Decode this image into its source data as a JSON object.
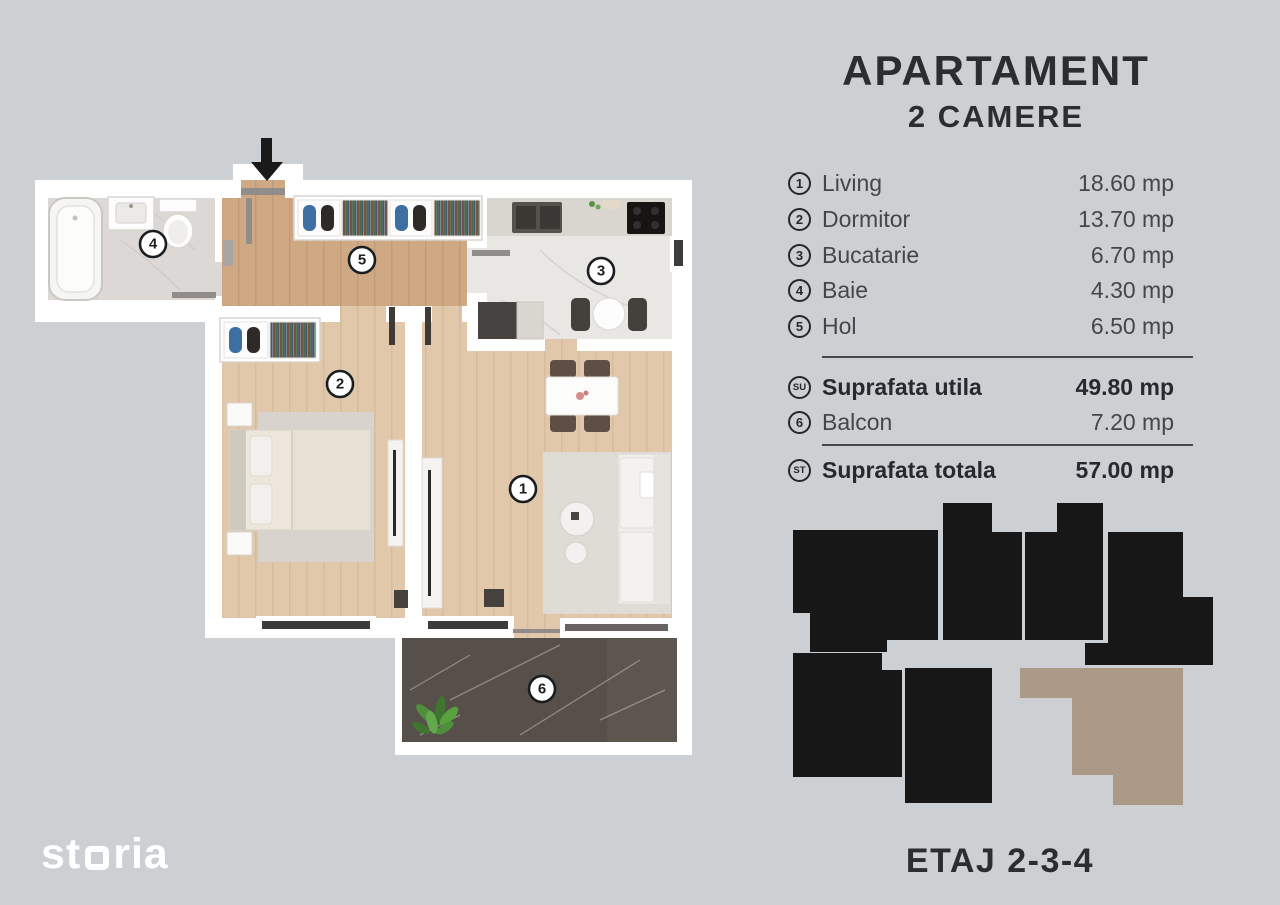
{
  "title": {
    "line1": "APARTAMENT",
    "line2": "2 CAMERE"
  },
  "legend": {
    "rooms": [
      {
        "num": "1",
        "name": "Living",
        "area": "18.60 mp"
      },
      {
        "num": "2",
        "name": "Dormitor",
        "area": "13.70 mp"
      },
      {
        "num": "3",
        "name": "Bucatarie",
        "area": "6.70 mp"
      },
      {
        "num": "4",
        "name": "Baie",
        "area": "4.30 mp"
      },
      {
        "num": "5",
        "name": "Hol",
        "area": "6.50 mp"
      }
    ],
    "suprafata_utila": {
      "badge": "SU",
      "label": "Suprafata utila",
      "area": "49.80 mp"
    },
    "balcon": {
      "num": "6",
      "name": "Balcon",
      "area": "7.20 mp"
    },
    "suprafata_totala": {
      "badge": "ST",
      "label": "Suprafata totala",
      "area": "57.00 mp"
    }
  },
  "floor_label": "ETAJ 2-3-4",
  "logo": {
    "part1": "st",
    "part2": "ria"
  },
  "plan": {
    "badges": {
      "living": "1",
      "dormitor": "2",
      "bucatarie": "3",
      "baie": "4",
      "hol": "5",
      "balcon": "6"
    }
  },
  "colors": {
    "background": "#ccd0d3",
    "text": "#43474a",
    "text_bold": "#26292d",
    "wall": "#ffffff",
    "floor_hall": "#cfa884",
    "floor_room": "#e1c8aa",
    "floor_kitchen": "#e9e7e4",
    "floor_bath": "#dbd8d5",
    "floor_balcony": "#57504a",
    "unit_black": "#171717",
    "unit_highlight": "#ab9a87"
  }
}
